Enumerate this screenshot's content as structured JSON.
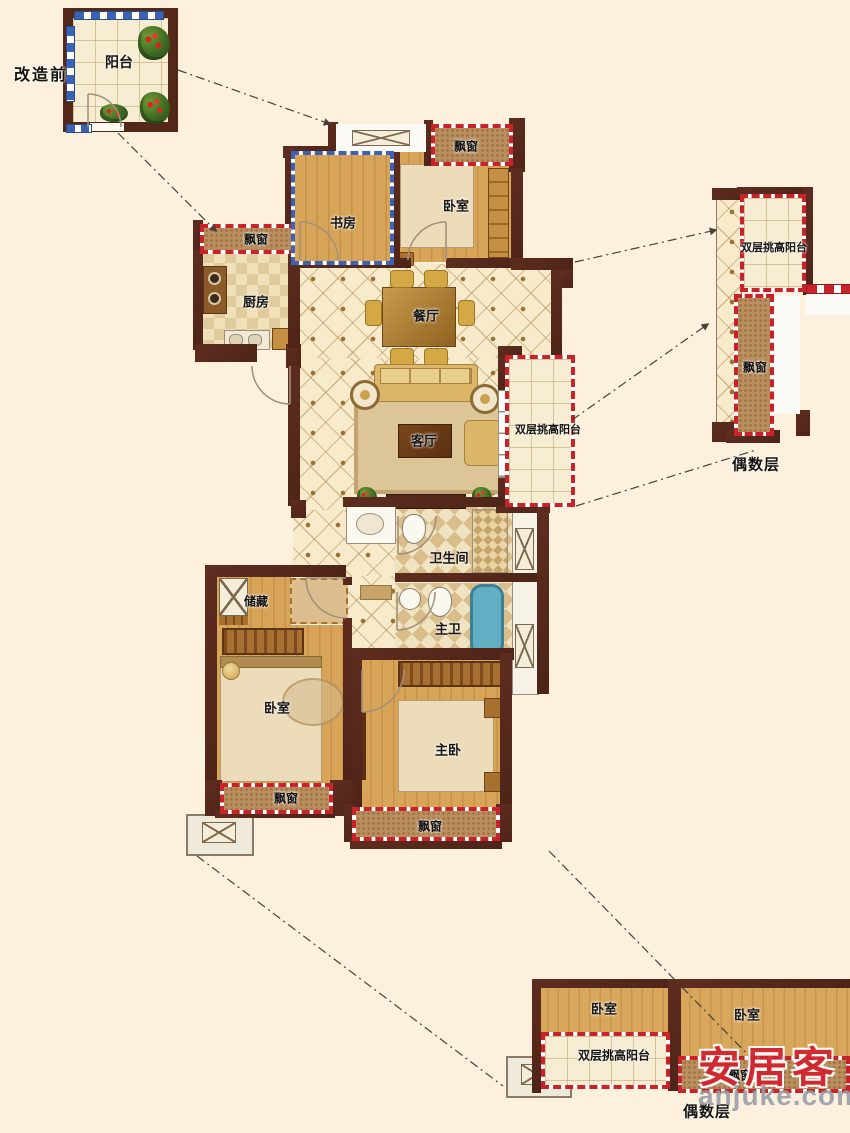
{
  "annotations": {
    "before_renovation": "改造前",
    "even_floor_right": "偶数层",
    "even_floor_bottom": "偶数层"
  },
  "top_left_unit": {
    "balcony": "阳台"
  },
  "main_unit": {
    "study": "书房",
    "bedroom_north": "卧室",
    "bay_north": "飘窗",
    "kitchen": "厨房",
    "bay_kitchen": "飘窗",
    "dining": "餐厅",
    "living": "客厅",
    "balcony_double": "双层挑高阳台",
    "bathroom": "卫生间",
    "master_bath": "主卫",
    "storage": "储藏",
    "bedroom_west": "卧室",
    "bay_west": "飘窗",
    "master_bedroom": "主卧",
    "bay_master": "飘窗"
  },
  "right_unit": {
    "balcony_double": "双层挑高阳台",
    "bay": "飘窗"
  },
  "bottom_unit": {
    "bedroom_left": "卧室",
    "bedroom_right": "卧室",
    "balcony_double": "双层挑高阳台",
    "bay": "飘窗"
  },
  "watermark": {
    "brand": "安居客",
    "site": "anjuke.com"
  },
  "colors": {
    "background": "#fdf1dd",
    "wall": "#5b2b1d",
    "window_red": "#c8232a",
    "window_blue": "#3a62b5",
    "watermark_red": "#d2232e"
  }
}
